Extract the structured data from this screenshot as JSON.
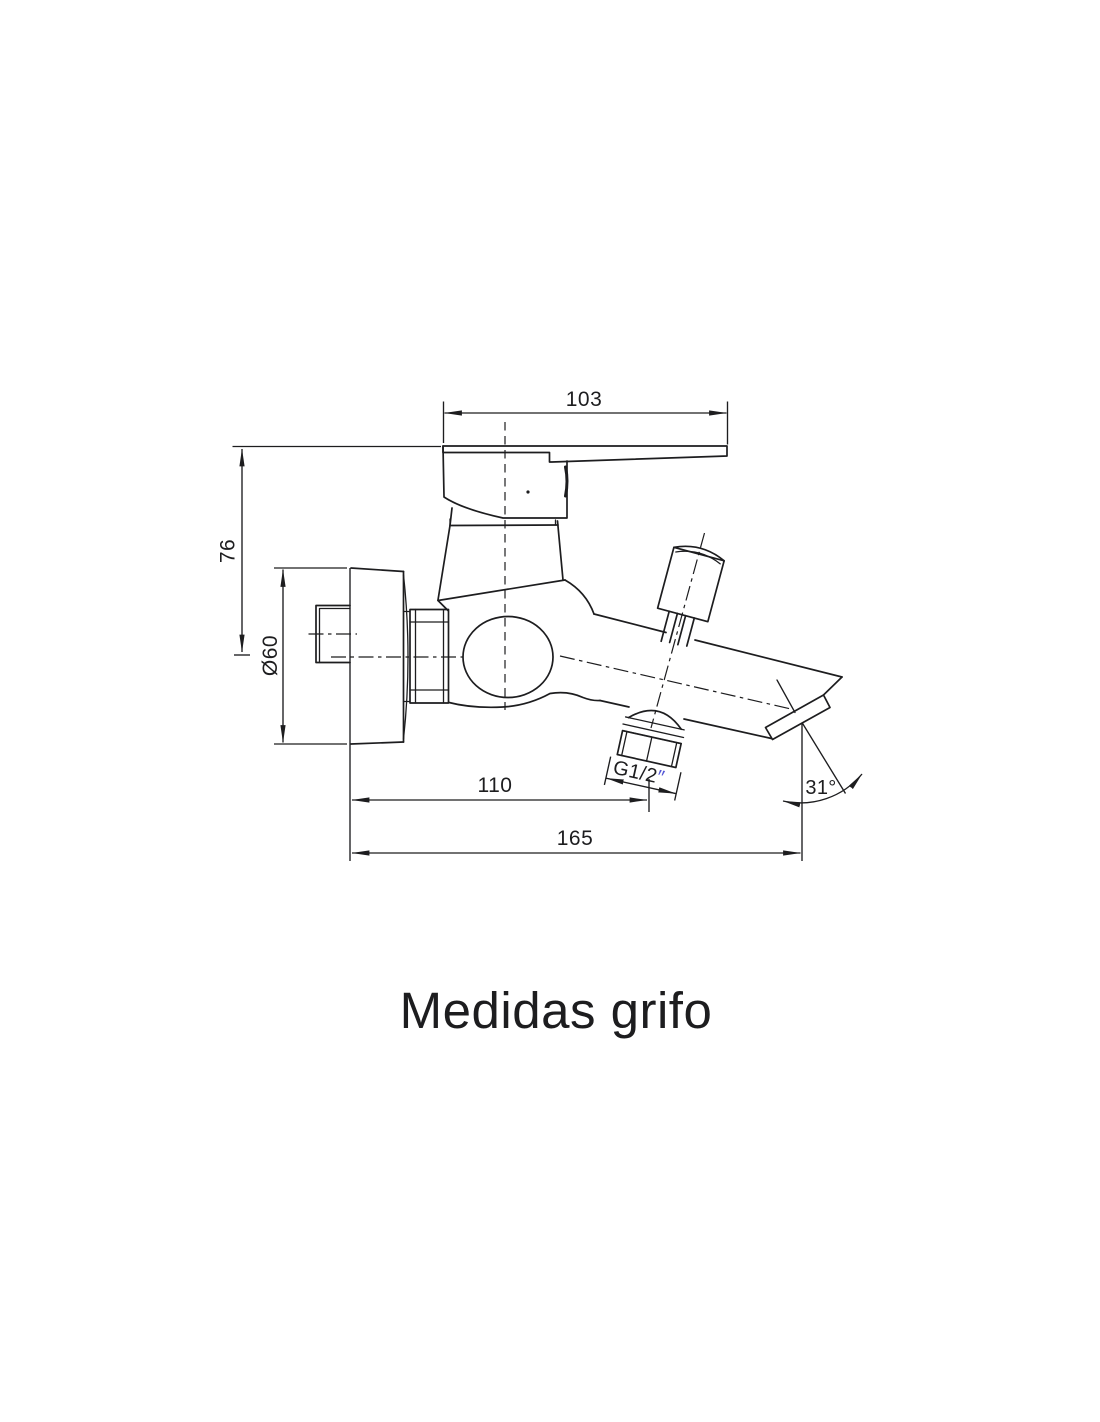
{
  "drawing": {
    "title": "Medidas grifo",
    "dimensions": {
      "handle_length": "103",
      "height_to_axis": "76",
      "flange_diameter": "Ø60",
      "shower_outlet_offset": "110",
      "spout_reach": "165",
      "outlet_thread": "G1/2",
      "outlet_thread_inches": "″",
      "spout_angle": "31°"
    },
    "colors": {
      "line": "#1d1d1f",
      "text": "#1d1d1f",
      "thread_inches_accent": "#5457d6",
      "background": "#ffffff"
    }
  }
}
